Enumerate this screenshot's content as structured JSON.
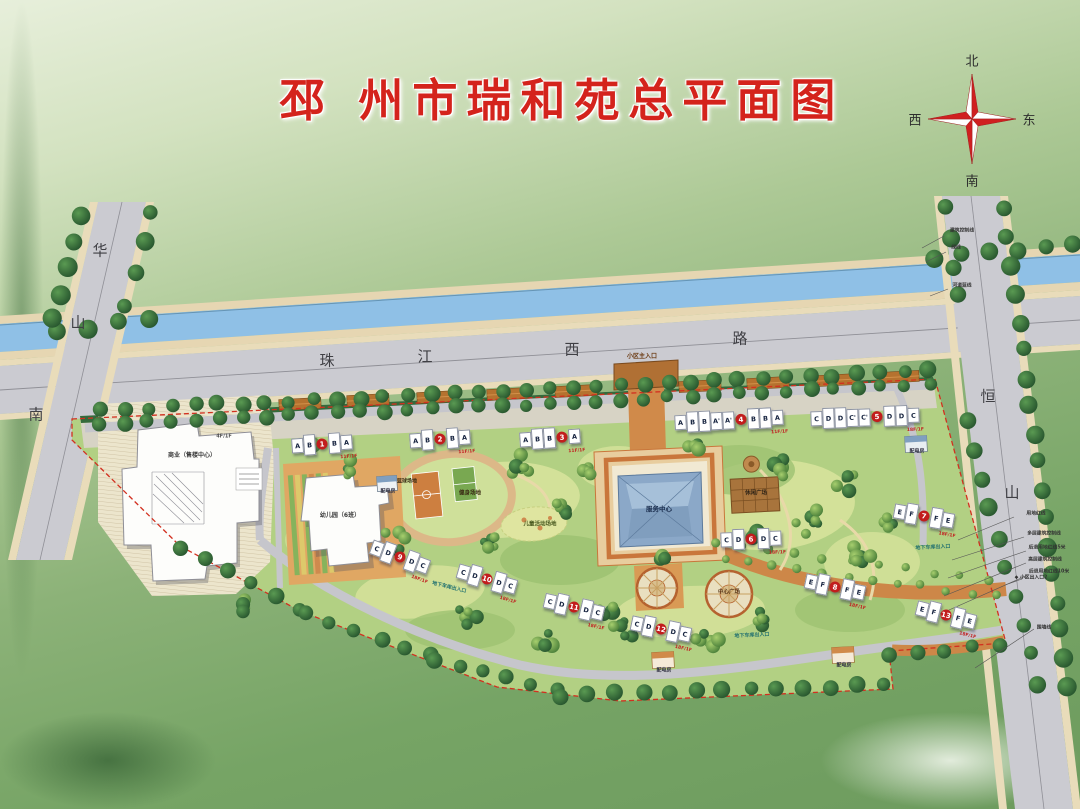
{
  "title": "邳 州市瑞和苑总平面图",
  "compass": {
    "north": "北",
    "south": "南",
    "east": "东",
    "west": "西"
  },
  "roads": [
    {
      "name": "珠江西路",
      "chars": [
        {
          "c": "珠",
          "x": 327,
          "y": 360
        },
        {
          "c": "江",
          "x": 425,
          "y": 356
        },
        {
          "c": "西",
          "x": 572,
          "y": 349
        },
        {
          "c": "路",
          "x": 740,
          "y": 338
        }
      ]
    },
    {
      "name": "华山南路",
      "chars": [
        {
          "c": "华",
          "x": 100,
          "y": 250
        },
        {
          "c": "山",
          "x": 78,
          "y": 322
        },
        {
          "c": "南",
          "x": 36,
          "y": 414
        }
      ]
    },
    {
      "name": "恒山路",
      "chars": [
        {
          "c": "恒",
          "x": 988,
          "y": 396
        },
        {
          "c": "山",
          "x": 1012,
          "y": 492
        }
      ]
    }
  ],
  "buildings": [
    {
      "num": "1",
      "units": [
        "A",
        "B",
        "#",
        "B",
        "A"
      ],
      "floors": "11F/1F",
      "x": 322,
      "y": 444,
      "rot": -4
    },
    {
      "num": "2",
      "units": [
        "A",
        "B",
        "#",
        "B",
        "A"
      ],
      "floors": "11F/1F",
      "x": 440,
      "y": 439,
      "rot": -4
    },
    {
      "num": "3",
      "units": [
        "A",
        "B",
        "B",
        "#",
        "A"
      ],
      "floors": "11F/1F",
      "x": 550,
      "y": 438,
      "rot": -4
    },
    {
      "num": "4",
      "units": [
        "A",
        "B",
        "B",
        "A'",
        "A'",
        "#",
        "B",
        "B",
        "A"
      ],
      "floors": "11F/1F",
      "x": 729,
      "y": 420,
      "rot": -3
    },
    {
      "num": "5",
      "units": [
        "C",
        "D",
        "D",
        "C'",
        "C'",
        "#",
        "D",
        "D",
        "C"
      ],
      "floors": "18F/1F",
      "x": 865,
      "y": 417,
      "rot": -2
    },
    {
      "num": "6",
      "units": [
        "C",
        "D",
        "#",
        "D",
        "C"
      ],
      "floors": "18F/1F",
      "x": 751,
      "y": 539,
      "rot": -2
    },
    {
      "num": "7",
      "units": [
        "E",
        "F",
        "#",
        "F",
        "E"
      ],
      "floors": "18F/1F",
      "x": 924,
      "y": 516,
      "rot": 10
    },
    {
      "num": "8",
      "units": [
        "E",
        "F",
        "#",
        "F",
        "E"
      ],
      "floors": "18F/1F",
      "x": 835,
      "y": 587,
      "rot": 12
    },
    {
      "num": "9",
      "units": [
        "C",
        "D",
        "#",
        "D",
        "C"
      ],
      "floors": "18F/1F",
      "x": 400,
      "y": 557,
      "rot": 20
    },
    {
      "num": "10",
      "units": [
        "C",
        "D",
        "#",
        "D",
        "C"
      ],
      "floors": "18F/1F",
      "x": 487,
      "y": 579,
      "rot": 16
    },
    {
      "num": "11",
      "units": [
        "C",
        "D",
        "#",
        "D",
        "C"
      ],
      "floors": "18F/1F",
      "x": 574,
      "y": 607,
      "rot": 13
    },
    {
      "num": "12",
      "units": [
        "C",
        "D",
        "#",
        "D",
        "C"
      ],
      "floors": "18F/1F",
      "x": 661,
      "y": 629,
      "rot": 12
    },
    {
      "num": "13",
      "units": [
        "E",
        "F",
        "#",
        "F",
        "E"
      ],
      "floors": "18F/1F",
      "x": 946,
      "y": 615,
      "rot": 14
    }
  ],
  "facilities": [
    {
      "label": "商业（售楼中心）",
      "x": 192,
      "y": 456,
      "s": 6,
      "c": "#3a3a3a"
    },
    {
      "label": "4F/1F",
      "x": 224,
      "y": 437,
      "s": 5,
      "c": "#555555"
    },
    {
      "label": "幼儿园（6班）",
      "x": 340,
      "y": 516,
      "s": 6,
      "c": "#3a3a3a"
    },
    {
      "label": "配电房",
      "x": 388,
      "y": 492,
      "s": 5,
      "c": "#333344"
    },
    {
      "label": "配电房",
      "x": 917,
      "y": 452,
      "s": 5,
      "c": "#333344"
    },
    {
      "label": "配电房",
      "x": 664,
      "y": 671,
      "s": 5,
      "c": "#333344"
    },
    {
      "label": "配电房",
      "x": 844,
      "y": 666,
      "s": 5,
      "c": "#333344"
    },
    {
      "label": "服务中心",
      "x": 659,
      "y": 509,
      "s": 6.5,
      "c": "#1d3050"
    },
    {
      "label": "休闲广场",
      "x": 756,
      "y": 494,
      "s": 5.5,
      "c": "#2e2317"
    },
    {
      "label": "健身场地",
      "x": 470,
      "y": 494,
      "s": 5.5,
      "c": "#3a2c14"
    },
    {
      "label": "篮球场地",
      "x": 407,
      "y": 482,
      "s": 5,
      "c": "#3a2c14"
    },
    {
      "label": "儿童活动场地",
      "x": 540,
      "y": 525,
      "s": 5.5,
      "c": "#4a5a20"
    },
    {
      "label": "中心广场",
      "x": 729,
      "y": 593,
      "s": 5.5,
      "c": "#5a3a1a"
    },
    {
      "label": "小区主入口",
      "x": 642,
      "y": 357,
      "s": 6,
      "c": "#6b3a12"
    },
    {
      "label": "地下车库出入口",
      "x": 752,
      "y": 636,
      "s": 5,
      "c": "#1f6f6f",
      "r": -3
    },
    {
      "label": "地下车库出入口",
      "x": 933,
      "y": 548,
      "s": 5,
      "c": "#1f6f6f",
      "r": -3
    },
    {
      "label": "地下车库出入口",
      "x": 449,
      "y": 588,
      "s": 5,
      "c": "#1f6f6f",
      "r": 14
    }
  ],
  "annotations": [
    {
      "label": "建筑控制线",
      "x": 962,
      "y": 232
    },
    {
      "label": "绿线",
      "x": 956,
      "y": 249
    },
    {
      "label": "河道蓝线",
      "x": 962,
      "y": 287
    },
    {
      "label": "用地红线",
      "x": 1036,
      "y": 515
    },
    {
      "label": "多层建筑控制线",
      "x": 1044,
      "y": 535
    },
    {
      "label": "后退用地红线5米",
      "x": 1047,
      "y": 549
    },
    {
      "label": "高层建筑控制线",
      "x": 1045,
      "y": 561
    },
    {
      "label": "后退用地红线10米",
      "x": 1049,
      "y": 573
    },
    {
      "label": "◆ 小区出入口2",
      "x": 1031,
      "y": 579
    },
    {
      "label": "围墙线",
      "x": 1044,
      "y": 629
    }
  ],
  "colors": {
    "title_red": "#d4231c",
    "boundary_red": "#d23020",
    "canal_blue": "#8fc0e6",
    "road_gray": "#cbcbd1",
    "lawn_green": "#b2d083",
    "tree_dark_green": "#2f6b39",
    "plaza_orange": "#cd8748",
    "building_white": "#ffffff",
    "unit_letter_navy": "#16233f",
    "badge_red": "#c21d1d"
  }
}
